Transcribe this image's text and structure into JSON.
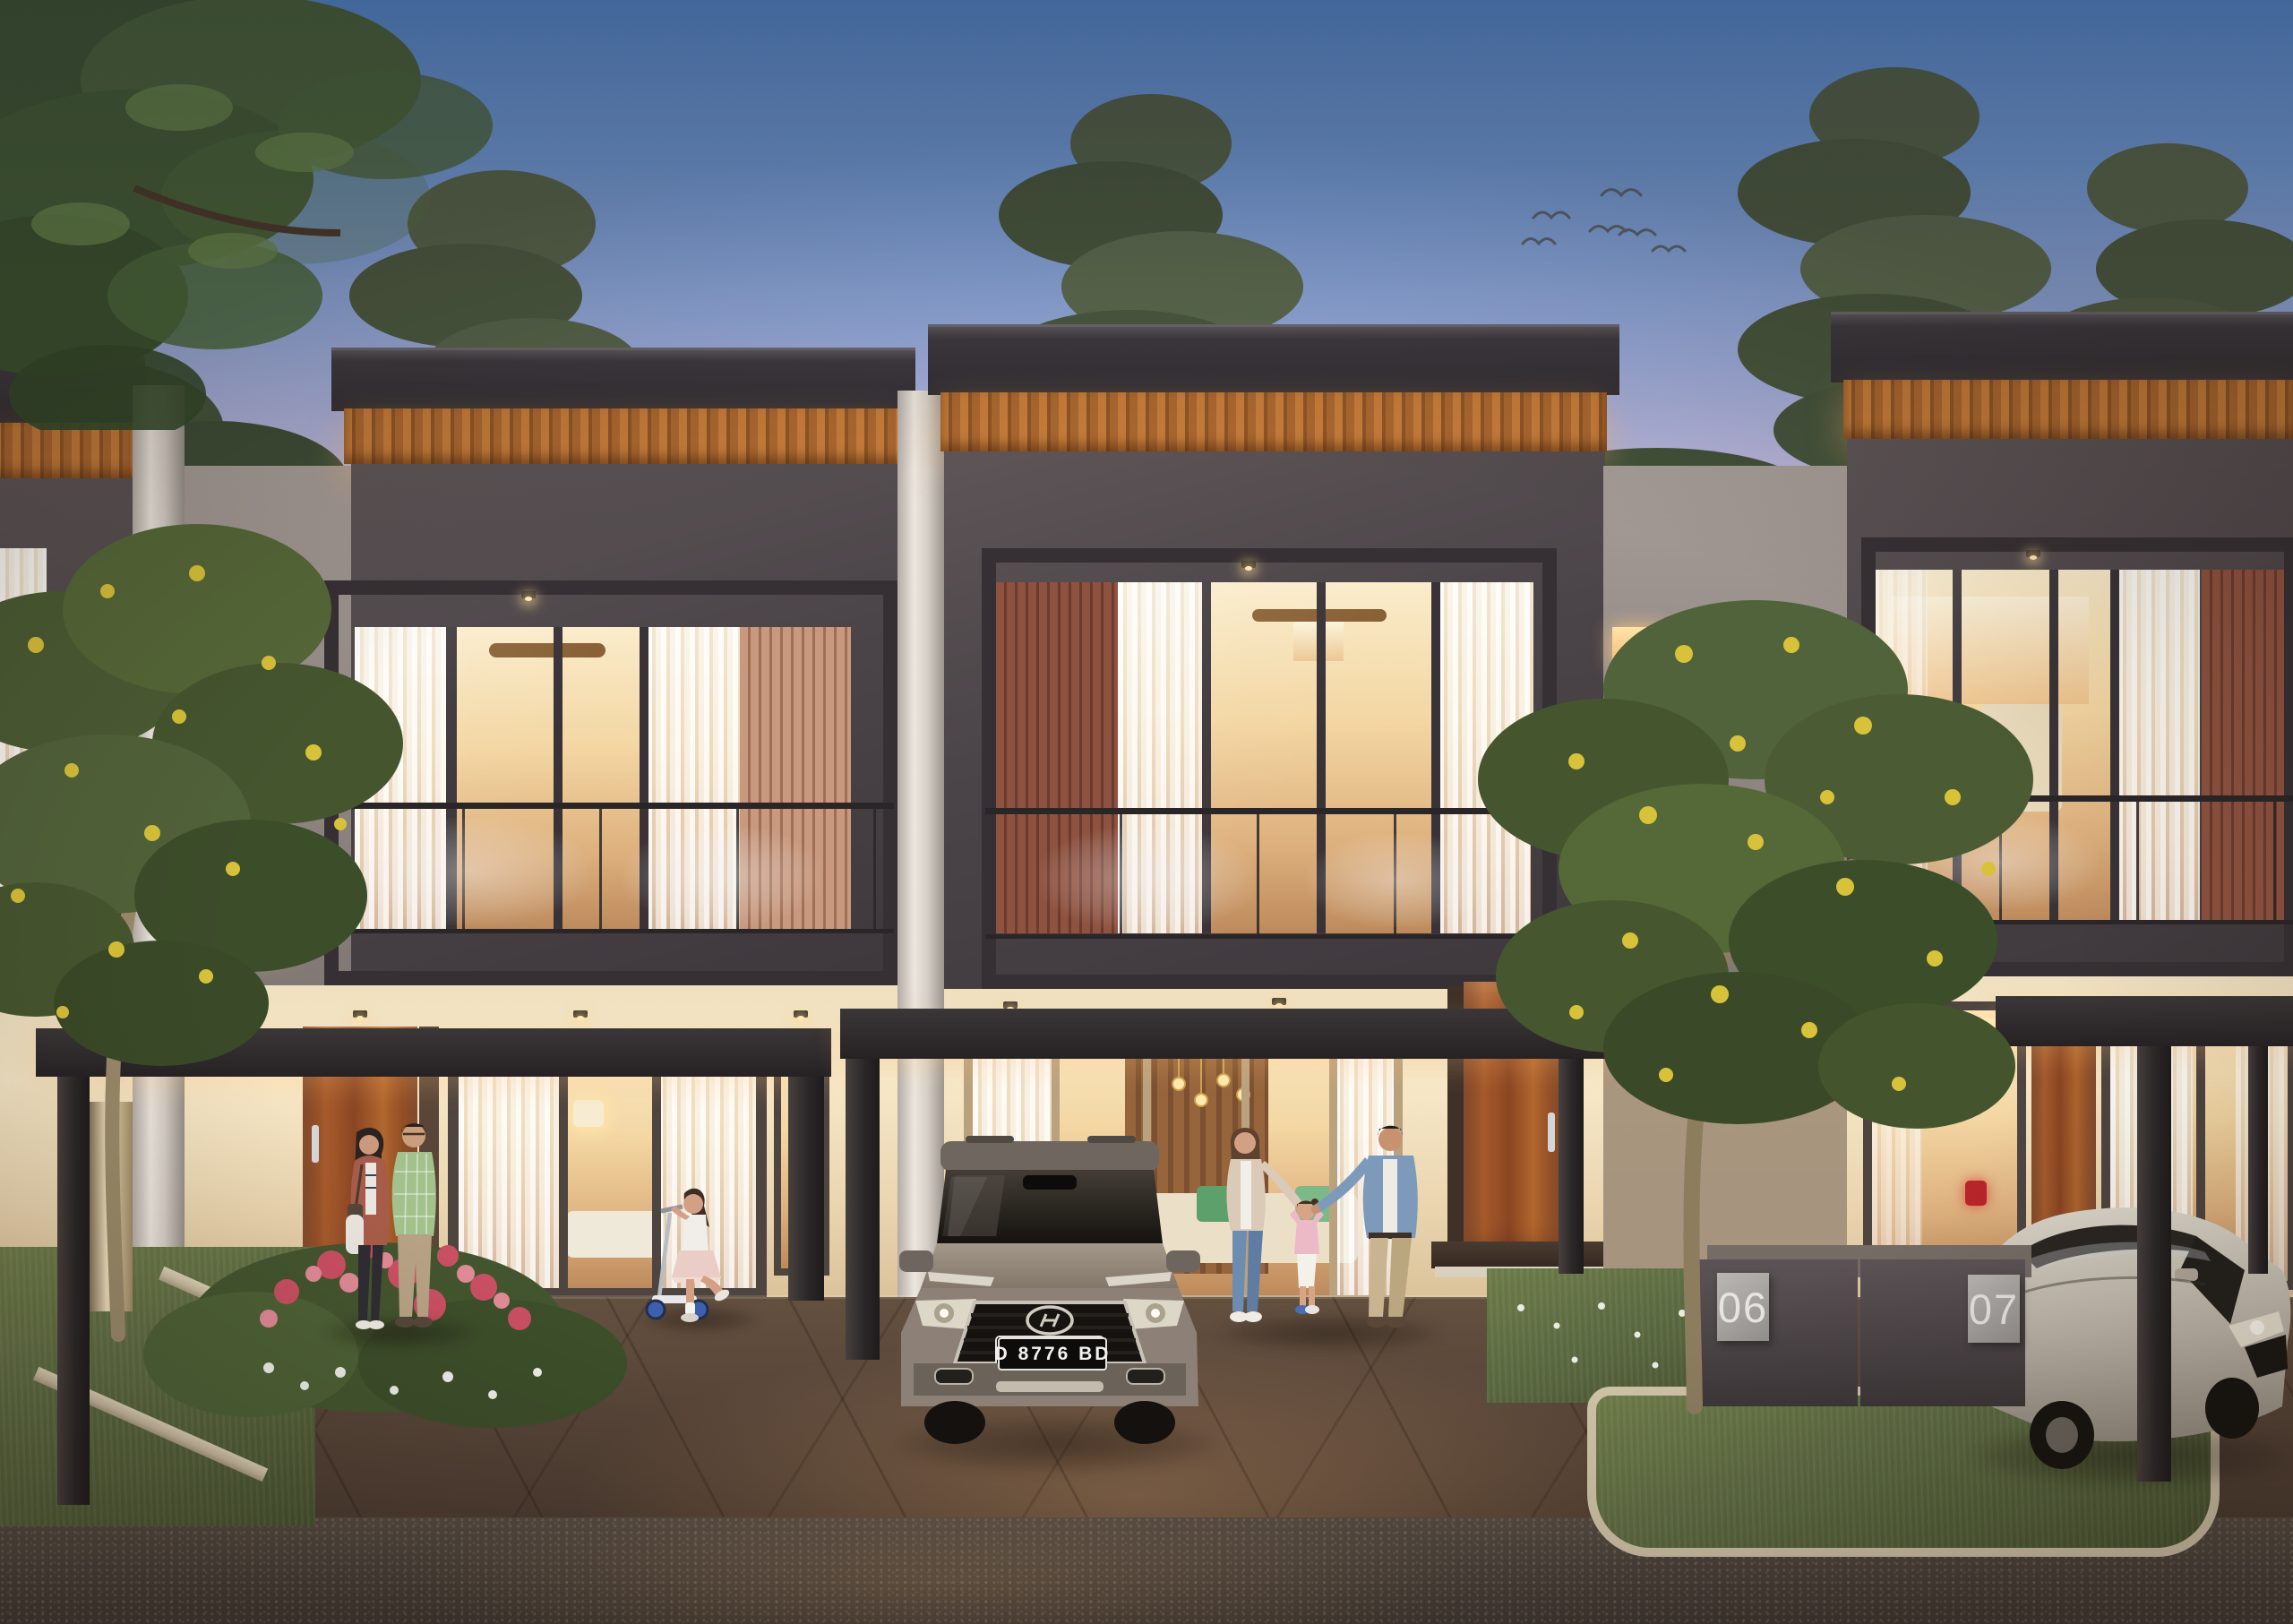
{
  "scene": {
    "description": "Photorealistic dusk rendering of a row of modern two-storey townhouses with wood-slat fascias, glass balcony railings, lit interiors, carports with parked cars, families outside, and pine trees behind",
    "time_of_day": "dusk",
    "texts": {
      "license_plate": "D 8776 BD",
      "house_number_left": "06",
      "house_number_right": "07"
    },
    "objects": [
      "pine-trees-backdrop",
      "overhanging-tree-canopy",
      "flying-birds",
      "townhouse-unit-row",
      "balcony-glass-railing",
      "wood-slat-fascia",
      "warm-lit-interior",
      "carport-canopy",
      "gray-hyundai-suv",
      "silver-hatchback-car",
      "red-taillight",
      "house-number-wall",
      "yellow-flowering-tree",
      "pink-flower-bed",
      "grass-verge",
      "concrete-curb",
      "couple-standing",
      "girl-on-kick-scooter",
      "family-walking-holding-hands",
      "asphalt-road",
      "paved-driveway"
    ],
    "palette": {
      "sky_top": "#558acf",
      "sky_horizon": "#e3d2c4",
      "roof": "#37343a",
      "fascia_wood": "#b06a33",
      "upper_facade": "#4a4347",
      "slat_panel_salmon": "#c8997e",
      "slat_panel_redbrown": "#8e5240",
      "lower_wall_cream": "#f0e0bf",
      "window_glow": "#f6dca8",
      "wood_door": "#9c4f2a",
      "driveway_brown": "#57443a",
      "road_asphalt": "#49413a",
      "grass_green": "#5d6b42",
      "curb_tan": "#cfc3a8",
      "suv_body_gray": "#8d8179",
      "silver_car": "#c9c2b6",
      "tree_foliage": "#4e5f38",
      "tree_flower_yellow": "#d8c23a",
      "flower_pink": "#c94f62"
    }
  }
}
